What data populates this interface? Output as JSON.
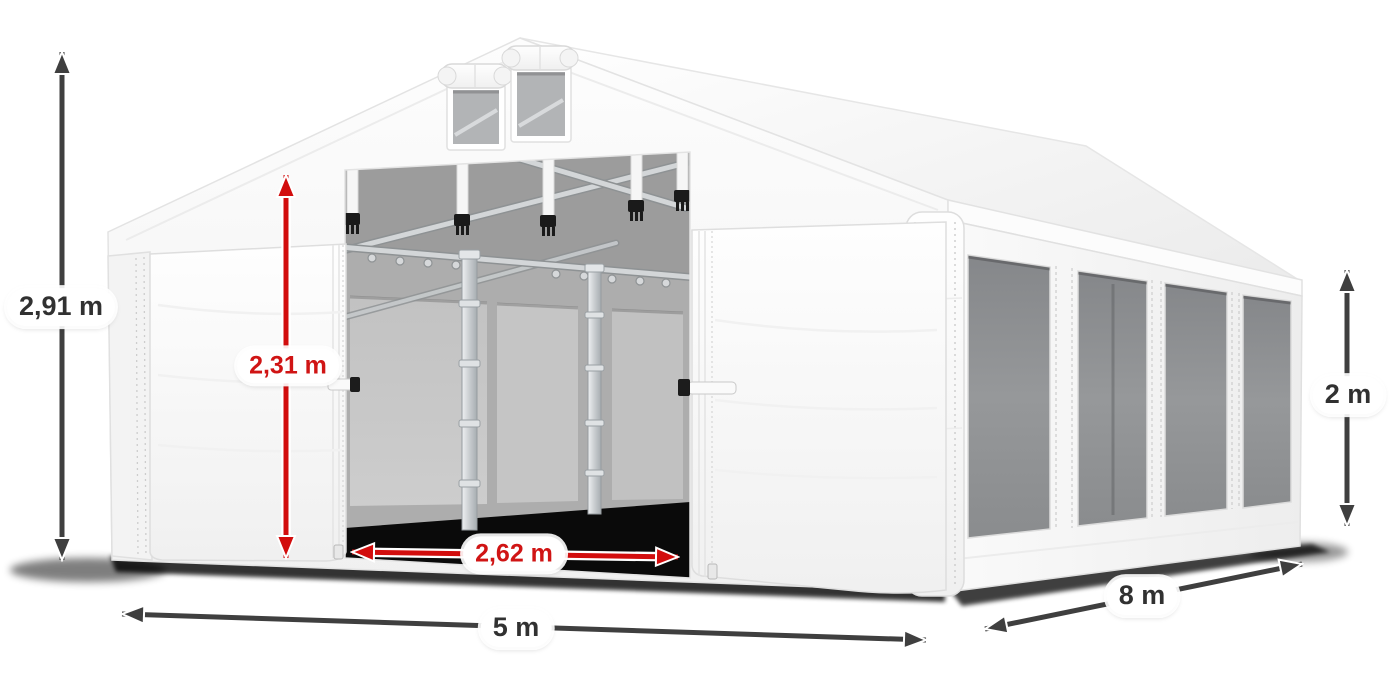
{
  "diagram": {
    "subject": "White party tent (marquee) shown in three-quarter perspective with dimension arrows",
    "background": "#ffffff",
    "colors": {
      "dark_arrow": "#3f3f3f",
      "dark_label_text": "#313131",
      "red_arrow": "#d20d0d",
      "red_label_text": "#d01414",
      "label_pill_background": "#ffffff",
      "tent_fabric": "#ffffff",
      "mesh_window": "#8d8f91",
      "interior_shadow": "#0a0a0a"
    },
    "measurements": {
      "total_height": {
        "label": "2,91 m",
        "color": "dark",
        "orientation": "vertical"
      },
      "entrance_height": {
        "label": "2,31 m",
        "color": "red",
        "orientation": "vertical"
      },
      "entrance_width": {
        "label": "2,62 m",
        "color": "red",
        "orientation": "horizontal"
      },
      "front_width": {
        "label": "5 m",
        "color": "dark",
        "orientation": "horizontal"
      },
      "side_length": {
        "label": "8 m",
        "color": "dark",
        "orientation": "diagonal"
      },
      "side_wall_height": {
        "label": "2 m",
        "color": "dark",
        "orientation": "vertical"
      }
    }
  }
}
